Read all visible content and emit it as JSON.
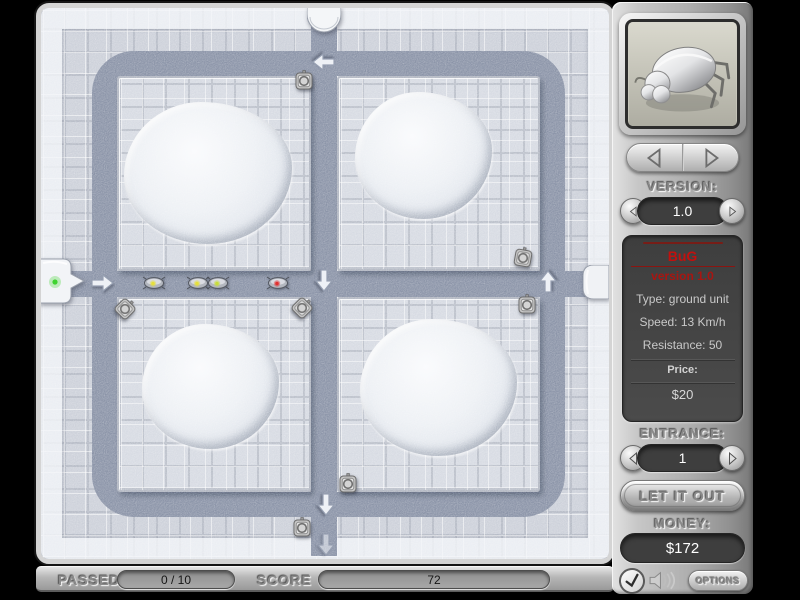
{
  "right_panel": {
    "version_label": "VERSION:",
    "version_value": "1.0",
    "info": {
      "title": "BuG",
      "subtitle": "version 1.0",
      "stats": [
        "Type: ground unit",
        "Speed: 13 Km/h",
        "Resistance: 50"
      ],
      "price_label": "Price:",
      "price_value": "$20"
    },
    "entrance_label": "ENTRANCE:",
    "entrance_value": "1",
    "release_button_label": "LET IT OUT",
    "money_label": "MONEY:",
    "money_value": "$172",
    "options_button_label": "OPTIONS"
  },
  "status_bar": {
    "passed_label": "PASSED",
    "passed_value": "0 / 10",
    "score_label": "SCORE",
    "score_value": "72"
  },
  "icons": {
    "prev_unit": "left-triangle-arrow",
    "next_unit": "right-triangle-arrow",
    "confirm": "check-mark",
    "sound": "speaker-waves"
  },
  "colors": {
    "path": "#8b94a8",
    "tile": "#cdd1da",
    "platform_tile": "#d7dbe3",
    "accent_red": "#c2100e",
    "money_text": "#ffffff",
    "bug_eye_yellow": "#e6e03a",
    "bug_eye_red": "#e03030",
    "entrance_green": "#3ed32f"
  },
  "board": {
    "tile": 23,
    "paths": {
      "loop": {
        "x": 51,
        "y": 43,
        "w": 473,
        "h": 466,
        "thickness": 25
      },
      "v_center": {
        "x": 270,
        "y": 14,
        "w": 26,
        "h": 534
      },
      "h_center": {
        "x": 0,
        "y": 263,
        "w": 568,
        "h": 26
      }
    },
    "platforms": [
      {
        "x": 76,
        "y": 68,
        "w": 194,
        "h": 195
      },
      {
        "x": 296,
        "y": 68,
        "w": 203,
        "h": 195
      },
      {
        "x": 76,
        "y": 289,
        "w": 194,
        "h": 195
      },
      {
        "x": 296,
        "y": 289,
        "w": 203,
        "h": 195
      }
    ],
    "mounds": [
      {
        "x": 83,
        "y": 94,
        "w": 168,
        "h": 142
      },
      {
        "x": 314,
        "y": 84,
        "w": 137,
        "h": 127
      },
      {
        "x": 101,
        "y": 316,
        "w": 137,
        "h": 125
      },
      {
        "x": 319,
        "y": 311,
        "w": 157,
        "h": 137
      }
    ],
    "towers": [
      {
        "x": 263,
        "y": 73,
        "rot": 0
      },
      {
        "x": 84,
        "y": 301,
        "rot": 45
      },
      {
        "x": 261,
        "y": 300,
        "rot": 45
      },
      {
        "x": 482,
        "y": 250,
        "rot": 10
      },
      {
        "x": 486,
        "y": 297,
        "rot": 0
      },
      {
        "x": 307,
        "y": 476,
        "rot": 0
      },
      {
        "x": 261,
        "y": 520,
        "rot": 0
      }
    ],
    "bugs": [
      {
        "x": 113,
        "y": 275,
        "eye": "#e6e03a"
      },
      {
        "x": 157,
        "y": 275,
        "eye": "#e6e03a"
      },
      {
        "x": 177,
        "y": 275,
        "eye": "#c8dd3a"
      },
      {
        "x": 237,
        "y": 275,
        "eye": "#e03030"
      }
    ],
    "arrows": [
      {
        "x": 61,
        "y": 275,
        "dir": "right"
      },
      {
        "x": 283,
        "y": 54,
        "dir": "left"
      },
      {
        "x": 283,
        "y": 272,
        "dir": "down"
      },
      {
        "x": 507,
        "y": 274,
        "dir": "up"
      },
      {
        "x": 285,
        "y": 496,
        "dir": "down"
      },
      {
        "x": 285,
        "y": 536,
        "dir": "down",
        "faint": true
      }
    ],
    "portals": {
      "top": {
        "x": 266,
        "y": -1,
        "w": 34,
        "h": 26
      },
      "left": {
        "x": -6,
        "y": 249,
        "w": 50,
        "h": 48
      },
      "right": {
        "x": 542,
        "y": 257,
        "w": 26,
        "h": 34
      }
    }
  }
}
